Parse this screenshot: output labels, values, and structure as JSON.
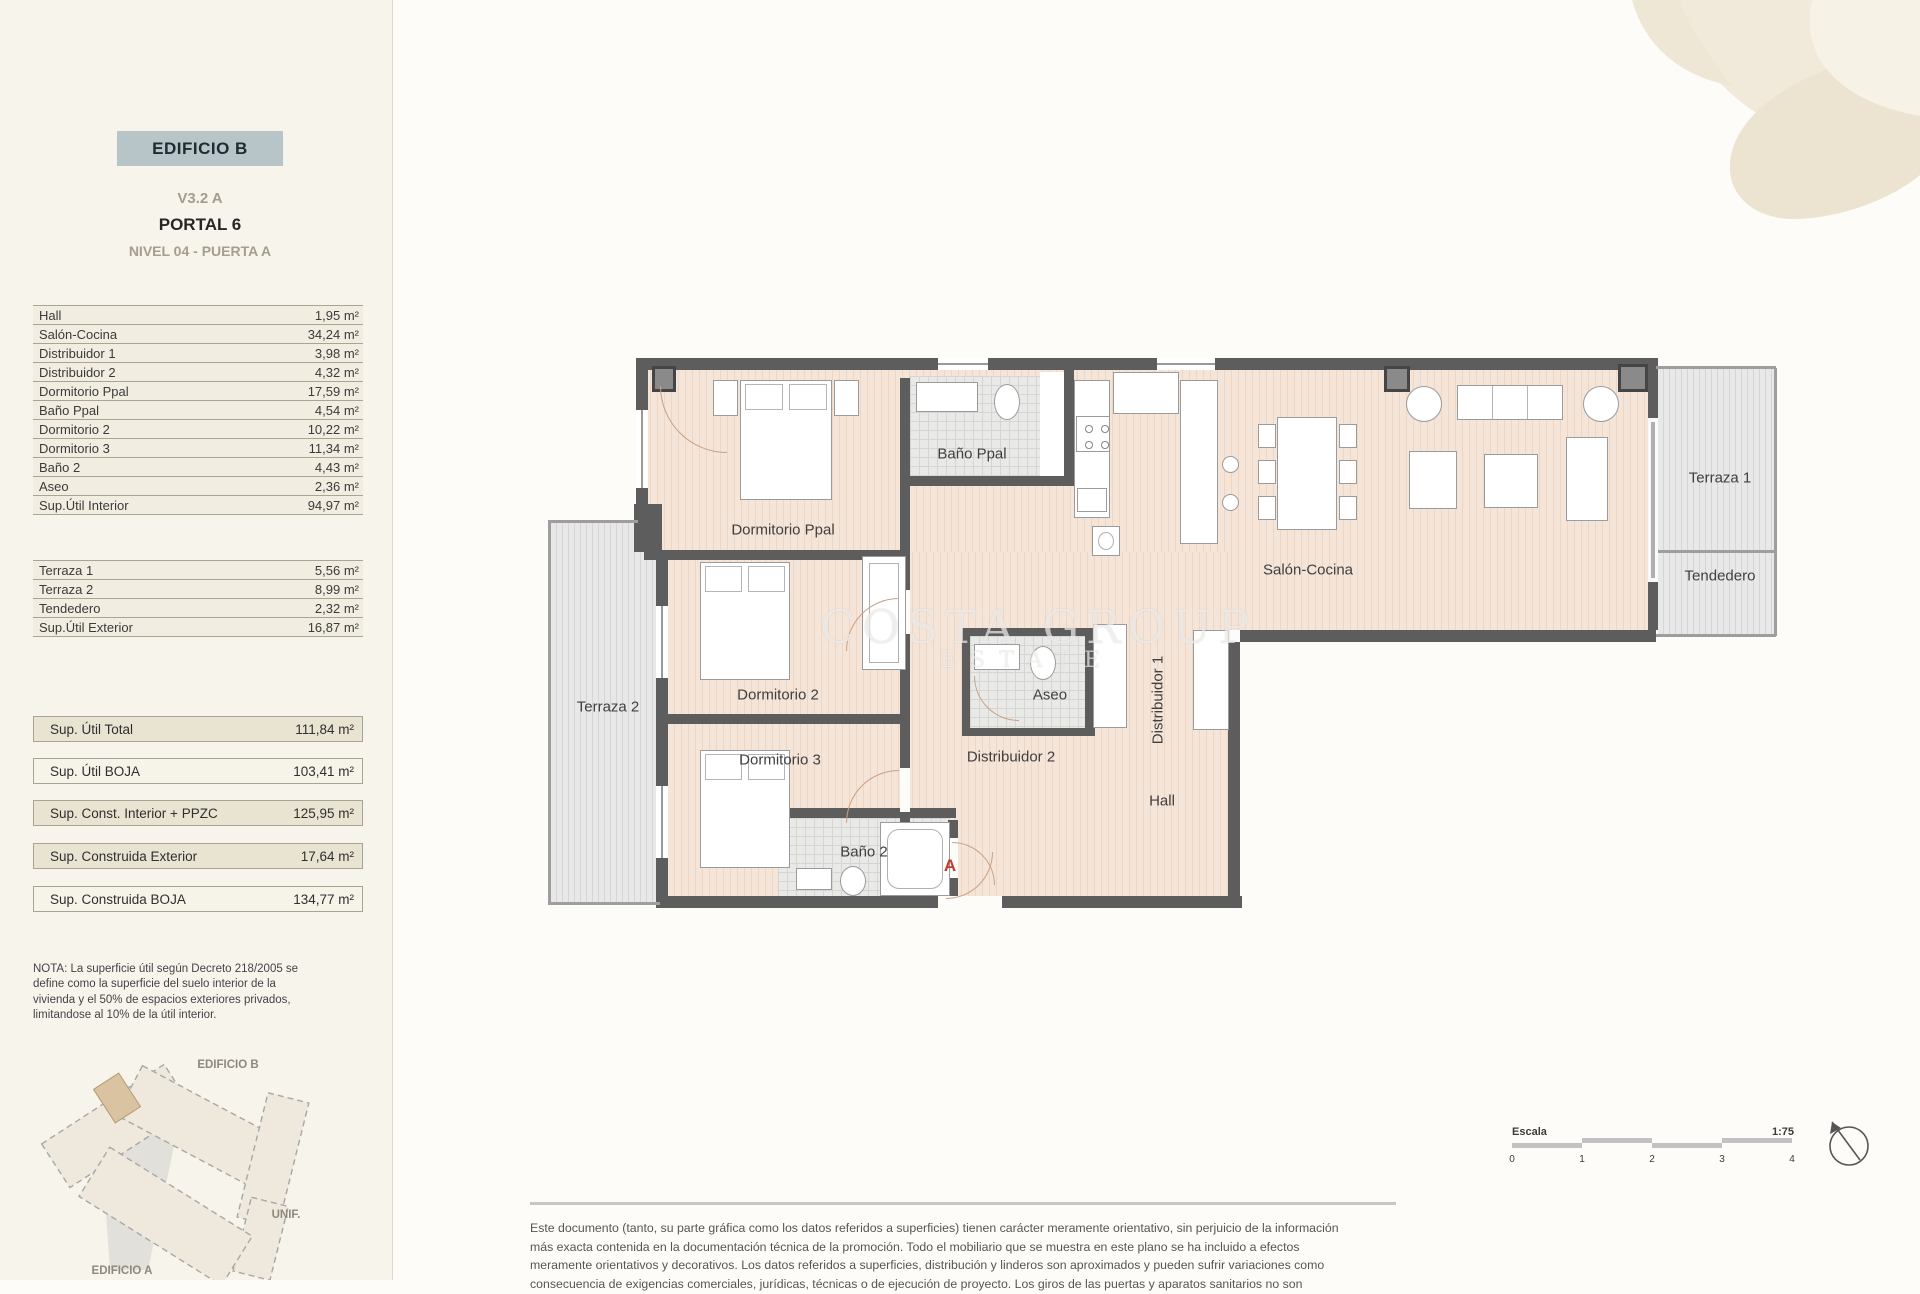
{
  "header": {
    "building": "EDIFICIO B",
    "version": "V3.2 A",
    "portal": "PORTAL 6",
    "level": "NIVEL 04 - PUERTA A"
  },
  "area": {
    "rows": [
      {
        "label": "Hall",
        "value": "1,95 m²"
      },
      {
        "label": "Salón-Cocina",
        "value": "34,24 m²"
      },
      {
        "label": "Distribuidor 1",
        "value": "3,98 m²"
      },
      {
        "label": "Distribuidor 2",
        "value": "4,32 m²"
      },
      {
        "label": "Dormitorio Ppal",
        "value": "17,59 m²"
      },
      {
        "label": "Baño Ppal",
        "value": "4,54 m²"
      },
      {
        "label": "Dormitorio 2",
        "value": "10,22 m²"
      },
      {
        "label": "Dormitorio 3",
        "value": "11,34 m²"
      },
      {
        "label": "Baño 2",
        "value": "4,43 m²"
      },
      {
        "label": "Aseo",
        "value": "2,36 m²"
      },
      {
        "label": "Sup.Útil Interior",
        "value": "94,97 m²"
      }
    ],
    "rows_ext": [
      {
        "label": "Terraza 1",
        "value": "5,56 m²"
      },
      {
        "label": "Terraza 2",
        "value": "8,99 m²"
      },
      {
        "label": "Tendedero",
        "value": "2,32 m²"
      },
      {
        "label": "Sup.Útil Exterior",
        "value": "16,87 m²"
      }
    ],
    "summary": [
      {
        "label": "Sup. Útil Total",
        "value": "111,84 m²"
      },
      {
        "label": "Sup. Útil BOJA",
        "value": "103,41 m²"
      },
      {
        "label": "Sup. Const. Interior + PPZC",
        "value": "125,95 m²"
      },
      {
        "label": "Sup. Construida Exterior",
        "value": "17,64 m²"
      },
      {
        "label": "Sup. Construida BOJA",
        "value": "134,77 m²"
      }
    ]
  },
  "nota": {
    "lines": [
      "NOTA: La superficie útil según Decreto 218/2005 se",
      "define como la superficie del suelo interior de la",
      "vivienda y el 50% de espacios exteriores privados,",
      "limitandose al 10% de la útil interior."
    ]
  },
  "site_map": {
    "label_b": "EDIFICIO B",
    "label_unif": "UNIF.",
    "label_a": "EDIFICIO A"
  },
  "plan": {
    "rooms": {
      "dormitorio_ppal": "Dormitorio Ppal",
      "bano_ppal": "Baño Ppal",
      "salon_cocina": "Salón-Cocina",
      "terraza_1": "Terraza 1",
      "tendedero": "Tendedero",
      "terraza_2": "Terraza 2",
      "dormitorio_2": "Dormitorio 2",
      "dormitorio_3": "Dormitorio 3",
      "aseo": "Aseo",
      "distribuidor_1": "Distribuidor 1",
      "distribuidor_2": "Distribuidor 2",
      "hall": "Hall",
      "bano_2": "Baño 2"
    },
    "entrance_label": "A",
    "watermark_line1": "COSTA GROUP",
    "watermark_line2": "ESTATE"
  },
  "scale_bar": {
    "label": "Escala",
    "ratio": "1:75",
    "ticks": [
      "0",
      "1",
      "2",
      "3",
      "4"
    ]
  },
  "disclaimer": {
    "lines": [
      "Este documento (tanto, su parte gráfica como los datos referidos a superficies) tienen carácter meramente orientativo, sin perjuicio de la información",
      "más exacta contenida en la documentación técnica de la promoción. Todo el mobiliario que se muestra en este plano se ha incluido a efectos",
      "meramente orientativos y decorativos. Los datos referidos a superficies, distribución y linderos son aproximados y pueden sufrir variaciones como",
      "consecuencia de exigencias comerciales, jurídicas, técnicas o de ejecución de proyecto. Los giros de las puertas y aparatos sanitarios no son"
    ]
  },
  "colors": {
    "accent_red": "#c23b2e",
    "wall": "#5d5d5d",
    "header_box": "#b7c5c8",
    "floor": "#f5e4d8",
    "terrace": "#dcdcdc"
  }
}
